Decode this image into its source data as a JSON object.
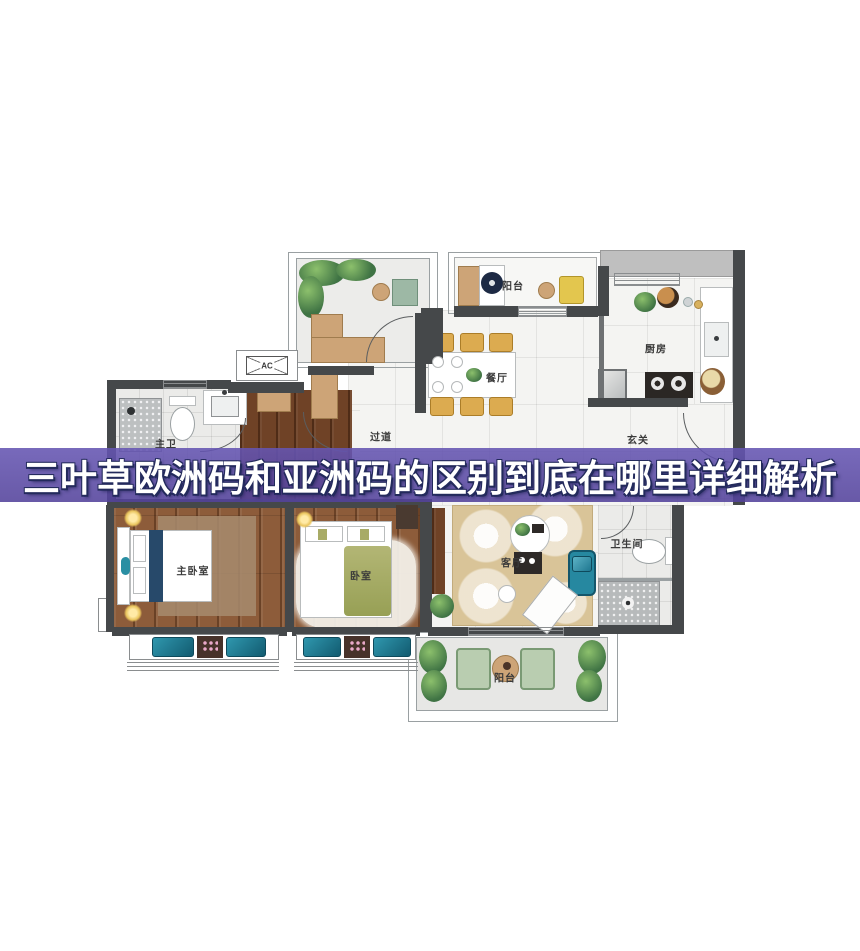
{
  "banner": {
    "text": "三叶草欧洲码和亚洲码的区别到底在哪里详细解析",
    "background_color": "#5C4CA6",
    "text_color": "#FFFFFF",
    "outline_color": "#232A5C"
  },
  "floorplan": {
    "labels": {
      "balcony_top": "阳台",
      "kitchen": "厨房",
      "dining": "餐厅",
      "hallway": "过道",
      "entry": "玄关",
      "master_bath": "主卫",
      "ac_unit": "AC",
      "master_bedroom": "主卧室",
      "bedroom": "卧室",
      "living_room": "客厅",
      "bathroom": "卫生间",
      "balcony_bottom": "阳台"
    },
    "colors": {
      "wall": "#45484A",
      "wood_floor": "#8D5C3A",
      "tile_floor": "#F4F4F2",
      "living_rug": "#D9C498",
      "accent_teal": "#2688A0",
      "bed_blanket_olive": "#A8AB66",
      "balcony_chair_green": "#B9CDB0",
      "dining_chair_tan": "#DCAB50"
    }
  }
}
